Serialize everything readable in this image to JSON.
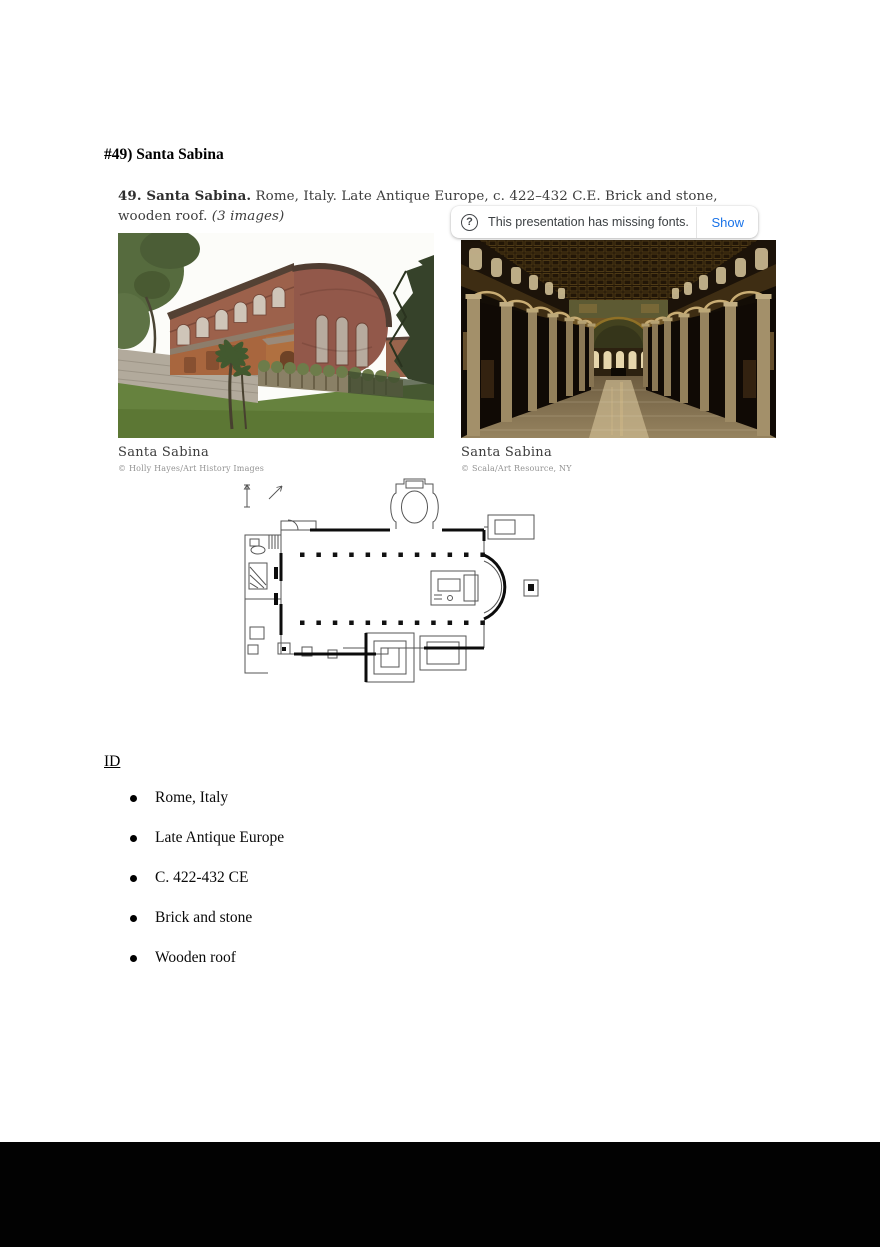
{
  "document": {
    "heading": "#49) Santa Sabina",
    "id_heading": "ID",
    "bullets": [
      "Rome, Italy",
      "Late Antique Europe",
      "C. 422-432 CE",
      "Brick and stone",
      "Wooden roof"
    ]
  },
  "slide": {
    "caption_bold": "49. Santa Sabina.",
    "caption_body": " Rome, Italy. Late Antique Europe, c. 422–432 C.E. Brick and stone, wooden roof. ",
    "caption_note": "(3 images)",
    "photos": [
      {
        "title": "Santa Sabina",
        "credit": "© Holly Hayes/Art History Images",
        "subject": "exterior brick basilica with apse, garden and trees"
      },
      {
        "title": "Santa Sabina",
        "credit": "© Scala/Art Resource, NY",
        "subject": "interior nave with colonnades and apse"
      }
    ],
    "floor_plan_icon": "basilica-floor-plan-drawing"
  },
  "toast": {
    "icon": "question-circle-icon",
    "message": "This presentation has missing fonts.",
    "action_label": "Show"
  },
  "colors": {
    "action_blue": "#1a73e8",
    "toast_text": "#3c4043",
    "footer_bar": "#020202",
    "brick": "#9c614b",
    "lawn_green": "#66823e"
  }
}
